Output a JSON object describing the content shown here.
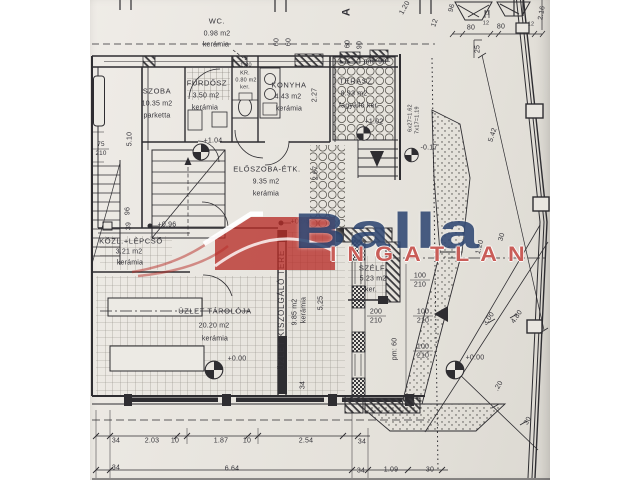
{
  "watermark": {
    "brand": "Balla",
    "sub": "INGATLAN"
  },
  "rooms": [
    {
      "name": "WC.",
      "area": "0.98 m2",
      "floor": "kerámia"
    },
    {
      "name": "SZOBA",
      "area": "10.35 m2",
      "floor": "parketta"
    },
    {
      "name": "FÜRDŐSZ",
      "area": "3.50 m2",
      "floor": "kerámia"
    },
    {
      "name": "KR.",
      "area": "0.80 m2",
      "floor": "ker.",
      "note": "1.80"
    },
    {
      "name": "KONYHA",
      "area": "4.43 m2",
      "floor": "kerámia"
    },
    {
      "name": "TERASZ",
      "area": "8.93 m2",
      "floor": "fagyálló ker."
    },
    {
      "name": "ELŐSZOBA-ÉTK.",
      "area": "9.35 m2",
      "floor": "kerámia"
    },
    {
      "name": "KÖZL.+LÉPCSŐ",
      "area": "3.21 m2",
      "floor": "kerámia"
    },
    {
      "name": "ÜZLET TÁROLÓJA",
      "area": "20.20 m2",
      "floor": "kerámia"
    },
    {
      "name": "ÜZLET KISZOLGÁLÓ TERE",
      "area": "9.85 m2",
      "floor": "kerámia"
    },
    {
      "name": "SZÉLF.",
      "area": "5.23 m2",
      "floor": "ker."
    }
  ],
  "levels": [
    "+1.04",
    "+1.02",
    "-0.17",
    "+0.96",
    "+0.96",
    "+0.00",
    "+0.00"
  ],
  "dims": {
    "upper": {
      "a60": "60",
      "b60": "60",
      "c60": "60",
      "d90": "90",
      "pm90": "pm: 90",
      "amark": "A"
    },
    "top": {
      "a80": "80",
      "d12a": "12",
      "b80": "80",
      "d12b": "12",
      "h216": "2.16",
      "v25": "25",
      "v11": "11",
      "v120": "1.20",
      "v96": "96",
      "v12": "12"
    },
    "left": {
      "w75": "75",
      "w210": "210",
      "v510": "5.10",
      "v96": "96",
      "v39": "39"
    },
    "mid": {
      "v227": "2.27",
      "v267": "2.67",
      "s1": "6x27=1.62",
      "s2": "7x17=1.19",
      "v525": "5,25",
      "v34": "34",
      "pm60": "pm: 60"
    },
    "openings": [
      [
        "100",
        "210"
      ],
      [
        "200",
        "210"
      ],
      [
        "100",
        "210"
      ],
      [
        "100",
        "210"
      ]
    ],
    "right": {
      "v542": "5.42",
      "v300": "3.00",
      "v480": "4.80",
      "v120": "1.20",
      "v30a": "30",
      "v20": ".20",
      "v30b": "30"
    },
    "bottom": {
      "r1": [
        "34",
        "2.03",
        "10",
        "1.87",
        "10",
        "2.54",
        "34"
      ],
      "r2": [
        "34",
        "6.64",
        "34",
        "1.09",
        "30"
      ]
    }
  },
  "colors": {
    "ink": "#2e2d31",
    "paper": "#e9e6e0",
    "brand_blue": "#1a3464",
    "brand_red": "#bd3933"
  }
}
